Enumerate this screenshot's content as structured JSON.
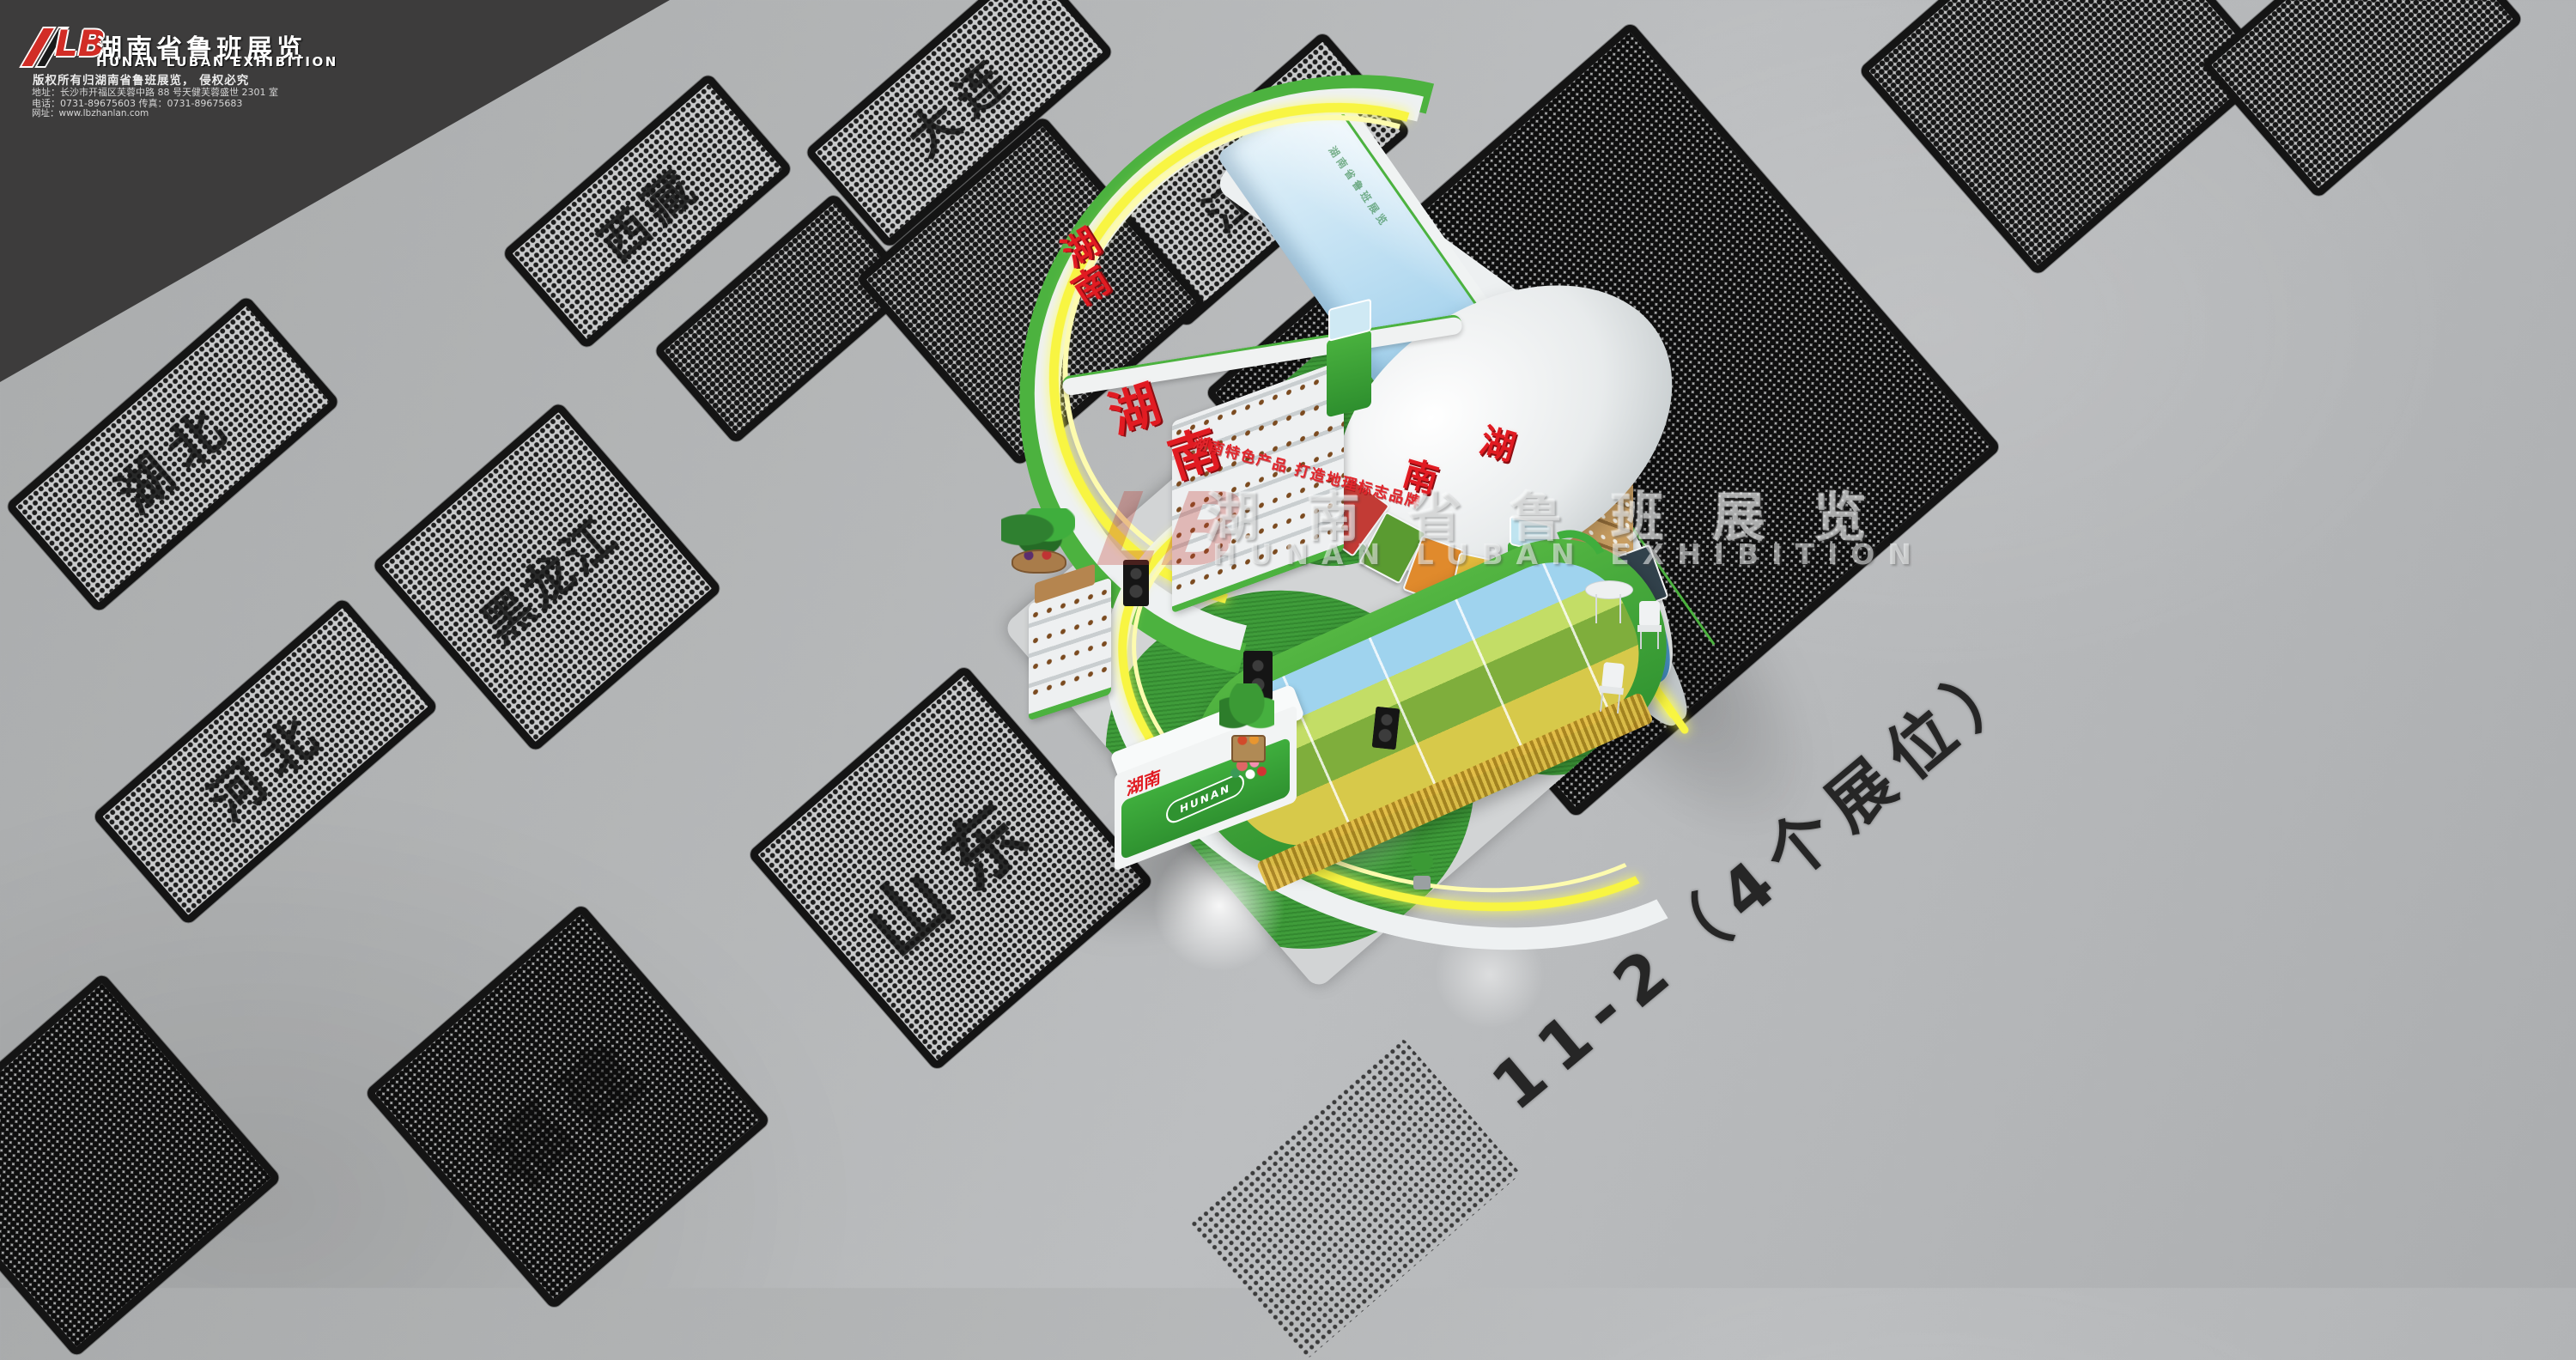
{
  "header": {
    "logo_text": "LB",
    "company_cn": "湖南省鲁班展览",
    "company_en": "HUNAN LUBAN EXHIBITION",
    "copyright_line": "版权所有归湖南省鲁班展览， 侵权必究",
    "address_line": "地址：长沙市开福区芙蓉中路 88 号天健芙蓉盛世 2301 室",
    "phone_fax_line": "电话：0731-89675603   传真：0731-89675683",
    "website_line": "网址：www.lbzhanlan.com"
  },
  "floorplan": {
    "area_label": "11-2（4个展位）",
    "tiles": [
      {
        "id": "xizang",
        "label": "西藏"
      },
      {
        "id": "dalian",
        "label": "大连"
      },
      {
        "id": "jiangxi",
        "label": "江西"
      },
      {
        "id": "hubei",
        "label": "湖北"
      },
      {
        "id": "hebei",
        "label": "河北"
      },
      {
        "id": "heilongjiang",
        "label": "黑龙江"
      },
      {
        "id": "shandong",
        "label": "山东"
      },
      {
        "id": "fujian",
        "label": "福建"
      },
      {
        "id": "partial-row2",
        "label": ""
      },
      {
        "id": "partial-behind-canopy",
        "label": ""
      },
      {
        "id": "partial-top-right-1",
        "label": ""
      },
      {
        "id": "partial-top-right-2",
        "label": ""
      },
      {
        "id": "booth-ground",
        "label": ""
      },
      {
        "id": "partial-bottom-left",
        "label": ""
      },
      {
        "id": "small-marker",
        "label": ""
      }
    ]
  },
  "watermark": {
    "logo": "LB",
    "cn": "湖南省鲁班展览",
    "en": "HUNAN LUBAN EXHIBITION"
  },
  "booth": {
    "calligraphy": [
      "湖",
      "南"
    ],
    "slogan": "湖南特色产品 打造地理标志品牌",
    "desk": {
      "cn": "湖南",
      "en": "HUNAN"
    },
    "colors": {
      "green": "#3fae3d",
      "light_green": "#4cb23f",
      "yellow_glow": "#f8f542",
      "sky_blue": "#8ec9e9",
      "red": "#e11b22",
      "grass": "#3f9c3a",
      "wood": "#c89e62",
      "white": "#eef1f2"
    },
    "food_strip_colors": [
      "#c23b35",
      "#5a9b31",
      "#e08a2c",
      "#e3b93c",
      "#46825a",
      "#7aa83e",
      "#d8d3c8",
      "#32424c"
    ]
  }
}
